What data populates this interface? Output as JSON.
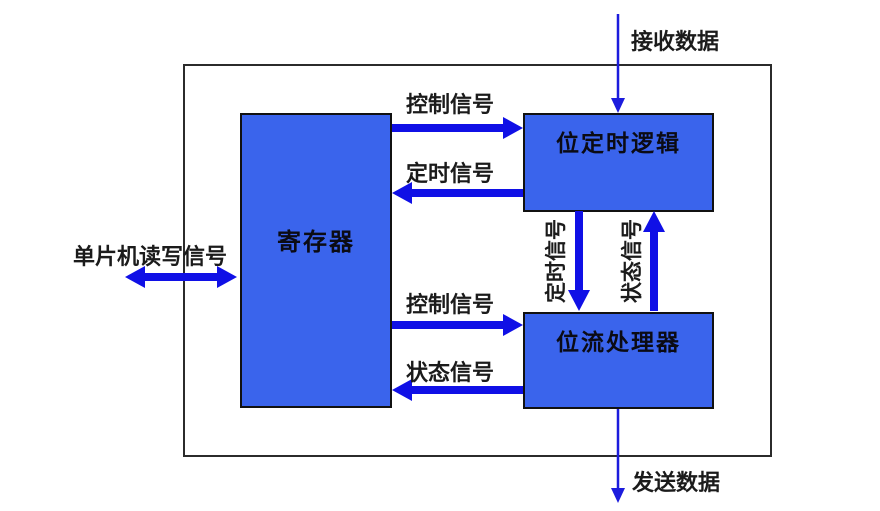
{
  "diagram": {
    "boxes": {
      "register": {
        "label": "寄存器"
      },
      "bit_timing_logic": {
        "label": "位定时逻辑"
      },
      "bit_stream_processor": {
        "label": "位流处理器"
      }
    },
    "signals": {
      "receive_data": "接收数据",
      "send_data": "发送数据",
      "control_signal_top": "控制信号",
      "timing_signal_top": "定时信号",
      "control_signal_bottom": "控制信号",
      "status_signal_bottom": "状态信号",
      "timing_signal_vertical": "定时信号",
      "status_signal_vertical": "状态信号",
      "mcu_read_write_signal": "单片机读写信号"
    },
    "colors": {
      "box_fill": "#3a64ec",
      "arrow_blue": "#1010e6",
      "boundary_border": "#2b2b2b",
      "text": "#1b1b1b"
    }
  }
}
